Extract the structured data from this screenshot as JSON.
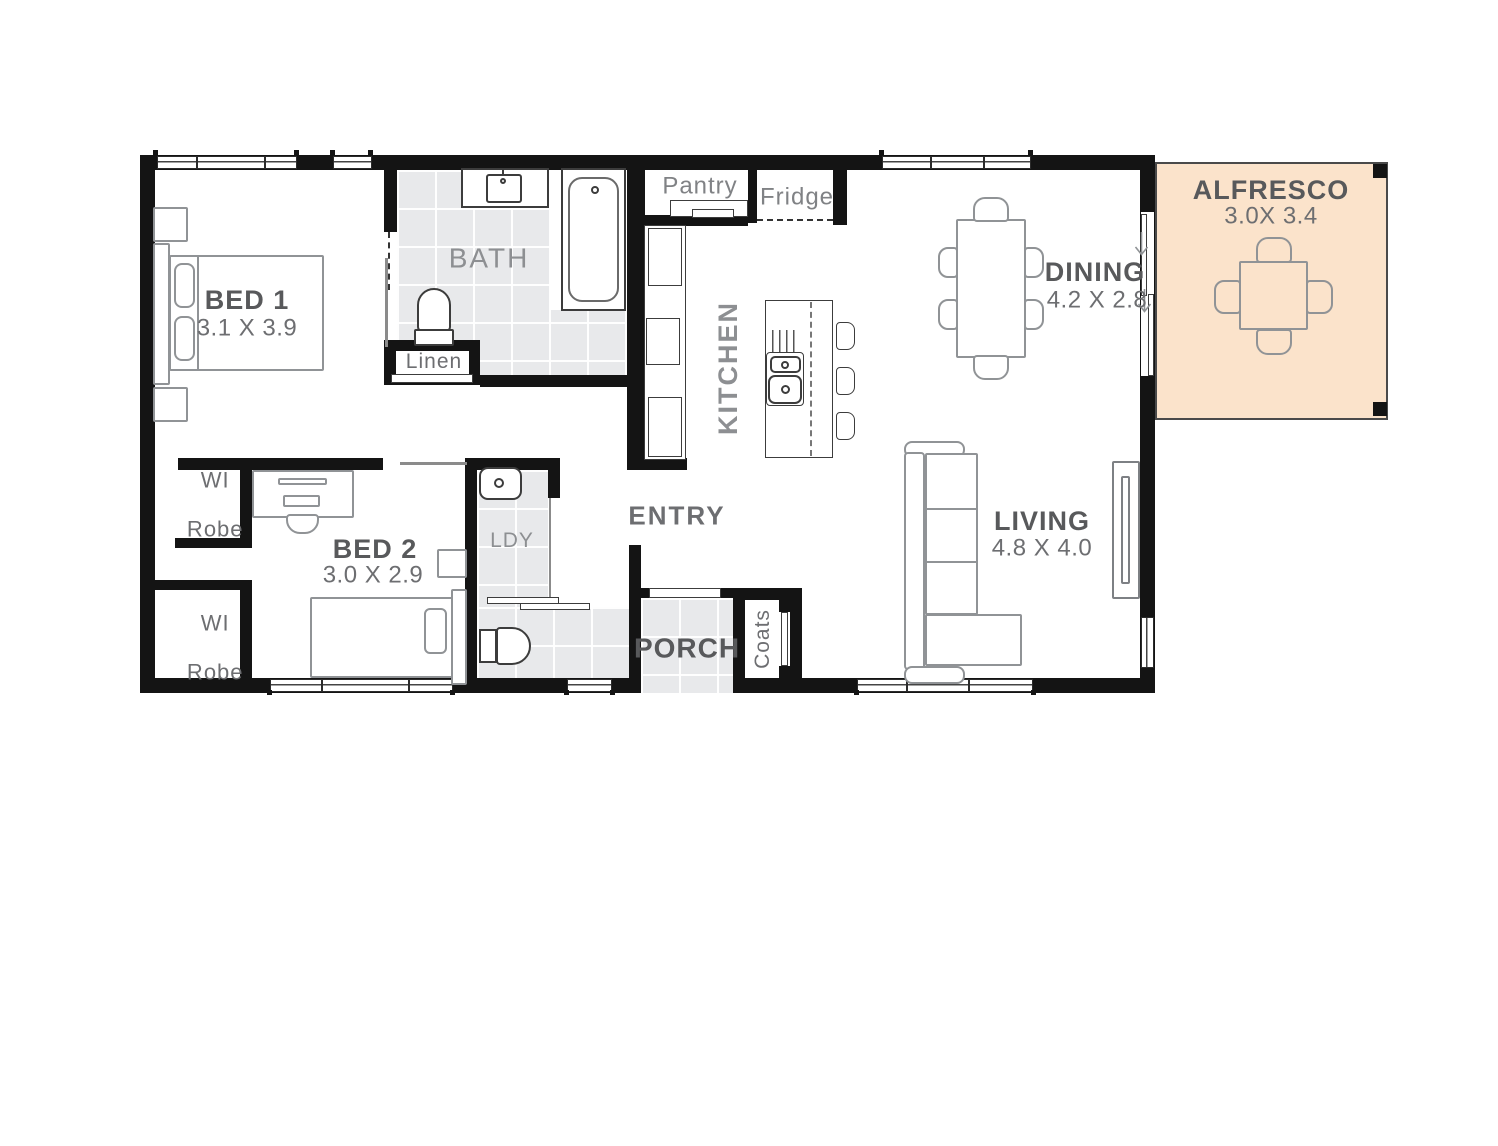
{
  "plan": {
    "rooms": {
      "bed1": {
        "name": "BED 1",
        "dims": "3.1 X 3.9"
      },
      "bed2": {
        "name": "BED 2",
        "dims": "3.0 X 2.9"
      },
      "dining": {
        "name": "DINING",
        "dims": "4.2 X 2.8"
      },
      "living": {
        "name": "LIVING",
        "dims": "4.8 X 4.0"
      },
      "alfresco": {
        "name": "ALFRESCO",
        "dims": "3.0X 3.4"
      },
      "bath": {
        "name": "BATH"
      },
      "kitchen": {
        "name": "KITCHEN"
      },
      "entry": {
        "name": "ENTRY"
      },
      "porch": {
        "name": "PORCH"
      },
      "laundry": {
        "name": "LDY"
      },
      "linen": {
        "name": "Linen"
      },
      "pantry": {
        "name": "Pantry"
      },
      "fridge": {
        "name": "Fridge"
      },
      "coats": {
        "name": "Coats"
      },
      "robe1": {
        "line1": "WI",
        "line2": "Robe"
      },
      "robe2": {
        "line1": "WI",
        "line2": "Robe"
      }
    },
    "colors": {
      "wall": "#141414",
      "tile": "#e8e9eb",
      "peach": "#fbe3cb",
      "ink_dark": "#58595b",
      "ink_mid": "#6d6e71",
      "ink_soft": "#808285",
      "ink_light": "#8d8f92",
      "furniture": "#909396",
      "fixture": "#3c3c3c"
    }
  }
}
